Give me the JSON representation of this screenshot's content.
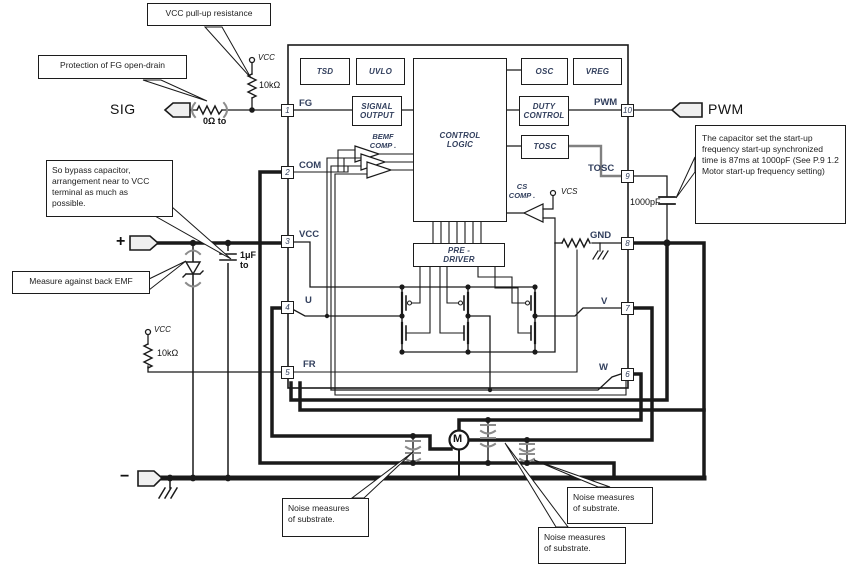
{
  "ic": {
    "blocks": {
      "tsd": "TSD",
      "uvlo": "UVLO",
      "osc": "OSC",
      "vreg": "VREG",
      "signal_output": "SIGNAL\nOUTPUT",
      "duty_control": "DUTY\nCONTROL",
      "control_logic": "CONTROL\nLOGIC",
      "tosc": "TOSC",
      "pre_driver": "PRE -\nDRIVER",
      "bemf_comp": "BEMF\nCOMP .",
      "cs_comp": "CS\nCOMP ."
    },
    "pins": {
      "left": [
        {
          "num": "1",
          "label": "FG"
        },
        {
          "num": "2",
          "label": "COM"
        },
        {
          "num": "3",
          "label": "VCC"
        },
        {
          "num": "4",
          "label": "U"
        },
        {
          "num": "5",
          "label": "FR"
        }
      ],
      "right": [
        {
          "num": "10",
          "label": "PWM"
        },
        {
          "num": "9",
          "label": "TOSC"
        },
        {
          "num": "8",
          "label": "GND"
        },
        {
          "num": "7",
          "label": "V"
        },
        {
          "num": "6",
          "label": "W"
        }
      ]
    }
  },
  "labels": {
    "sig": "SIG",
    "pwm_ext": "PWM",
    "plus": "+",
    "minus": "−",
    "vcc_pullup": "VCC",
    "vcc_fr": "VCC",
    "vcs": "VCS",
    "r_pullup": "10kΩ",
    "r_fr": "10kΩ",
    "r_series": "0Ω to",
    "c_bypass": "1μF\nto",
    "c_tosc": "1000pF",
    "motor": "M"
  },
  "callouts": {
    "pullup": "VCC pull-up resistance",
    "fg_protection": "Protection of FG open-drain",
    "bypass": "So bypass capacitor,\narrangement near to VCC\nterminal as much as\npossible.",
    "back_emf": "Measure against back EMF",
    "startup": "The capacitor set the start-up frequency start-up synchronized time is 87ms at 1000pF (See P.9 1.2 Motor start-up frequency setting)",
    "noise1": "Noise measures\nof substrate.",
    "noise2": "Noise measures\nof substrate.",
    "noise3": "Noise measures\nof substrate."
  },
  "colors": {
    "wire": "#1a1a1a",
    "ic_text": "#33405e",
    "gray": "#8c8c8c"
  }
}
